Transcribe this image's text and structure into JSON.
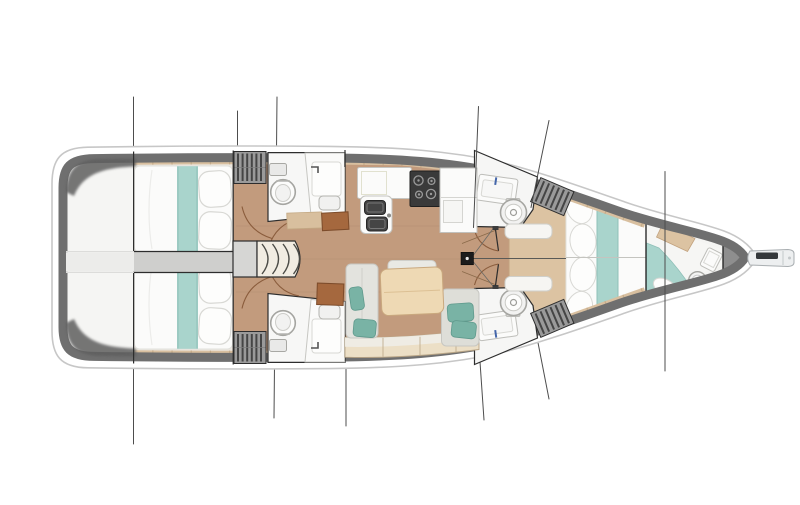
{
  "meta": {
    "title": "Sailing yacht interior deck plan, top view, bow pointing right",
    "style": "rendered floor-plan illustration, no visible text labels"
  },
  "colors": {
    "page_bg": "#ffffff",
    "hull_outline": "#c7c7c7",
    "hull_white": "#ffffff",
    "gunwale": "#6f6f6f",
    "wedge": "#5f5f5f",
    "deck_white": "#f1f0ed",
    "stern_deck": "#f5f5f3",
    "cabin_floor": "#ece7df",
    "floor_wood": "#c29b7d",
    "floor_seam": "#b08a6d",
    "side_deck": "#d8bf9f",
    "side_deck_seam": "#b79a77",
    "corridor": "#cfcfcd",
    "corridor_faint": "#ececea",
    "wall": "#2d2d2d",
    "door_arc": "#8a5c3c",
    "bed_white": "#fbfbfa",
    "bed_edge": "#e0e0dc",
    "bed_teal": "#a9d4cc",
    "bed_teal_edge": "#8fc0b8",
    "pillow": "#fdfdfc",
    "pillow_edge": "#d8d8d4",
    "wardrobe": "#9a9a9a",
    "wardrobe_stripe": "#454545",
    "head_floor": "#f7f7f6",
    "fixture_white": "#fbfbfa",
    "fixture_stroke": "#bdbdb9",
    "counter_line": "#d8d8d4",
    "toilet_stroke": "#a5a5a1",
    "sink_dark": "#454545",
    "stove_dark": "#3a3a3a",
    "burner": "#9a9a9a",
    "stairs_fill": "#f1ece2",
    "stairs_line": "#4b4b46",
    "landing": "#d6d6d4",
    "settee": "#e3e3de",
    "settee_stroke": "#c7c7c2",
    "cushion_teal": "#79b3a5",
    "cushion_teal_edge": "#5f998c",
    "table_wood": "#eed9b4",
    "table_edge": "#c9a87e",
    "bench_wood": "#ecdfc6",
    "bench_edge": "#b9a586",
    "platform_wood": "#dcc3a2",
    "platform_edge": "#c2a27e",
    "brown_table": "#a5683e",
    "brown_table_edge": "#7d4c2b",
    "tan_table": "#d8bf9e",
    "mast": "#1c1c1c",
    "rigging": "#4d4d4d",
    "anchor_locker": "#8e8e8e",
    "anchor_edge": "#6a6a6a",
    "bowsprit": "#edeff0",
    "bowsprit_edge": "#a8adb0",
    "windlass": "#34383b",
    "faucet_blue": "#4466aa",
    "faucet_dark": "#555555",
    "centerline": "#5a5a56"
  },
  "hull": {
    "orientation": "bow-right",
    "stay_line_count": 7,
    "symmetry_axis_y": 257.5
  },
  "rooms": [
    {
      "id": "stern-locker",
      "label": "Stern / transom locker"
    },
    {
      "id": "aft-cabin-top",
      "label": "Aft double cabin (starboard)",
      "furniture": [
        "double berth",
        "teal runner",
        "two pillows"
      ]
    },
    {
      "id": "aft-cabin-bottom",
      "label": "Aft double cabin (port)",
      "furniture": [
        "double berth",
        "teal runner",
        "two pillows"
      ]
    },
    {
      "id": "aft-head-top",
      "label": "Aft head (starboard)",
      "furniture": [
        "toilet",
        "sink counter"
      ]
    },
    {
      "id": "aft-head-bottom",
      "label": "Aft head (port)",
      "furniture": [
        "toilet",
        "sink counter"
      ]
    },
    {
      "id": "companionway",
      "label": "Companionway",
      "furniture": [
        "landing",
        "four curved steps"
      ]
    },
    {
      "id": "galley",
      "label": "Galley",
      "furniture": [
        "double sink",
        "stove with burners",
        "refrigerator counter"
      ]
    },
    {
      "id": "saloon",
      "label": "Saloon",
      "furniture": [
        "U-shaped settee",
        "dining table",
        "teal cushions"
      ]
    },
    {
      "id": "fwd-head-top",
      "label": "Forward head (starboard)",
      "furniture": [
        "sink",
        "toilet",
        "hanging locker"
      ]
    },
    {
      "id": "fwd-head-bottom",
      "label": "Forward head (port)",
      "furniture": [
        "sink",
        "toilet",
        "hanging locker"
      ]
    },
    {
      "id": "owner-cabin",
      "label": "Forward owner cabin",
      "furniture": [
        "island berth",
        "teal runner",
        "scalloped pillows",
        "two bench seats"
      ]
    },
    {
      "id": "forepeak",
      "label": "Forepeak crew cabin",
      "furniture": [
        "berth",
        "toilet",
        "washbasin"
      ]
    },
    {
      "id": "anchor-locker",
      "label": "Anchor locker"
    },
    {
      "id": "bowsprit",
      "label": "Bowsprit with anchor roller"
    }
  ],
  "mast": {
    "location": "centerline forward of saloon"
  }
}
